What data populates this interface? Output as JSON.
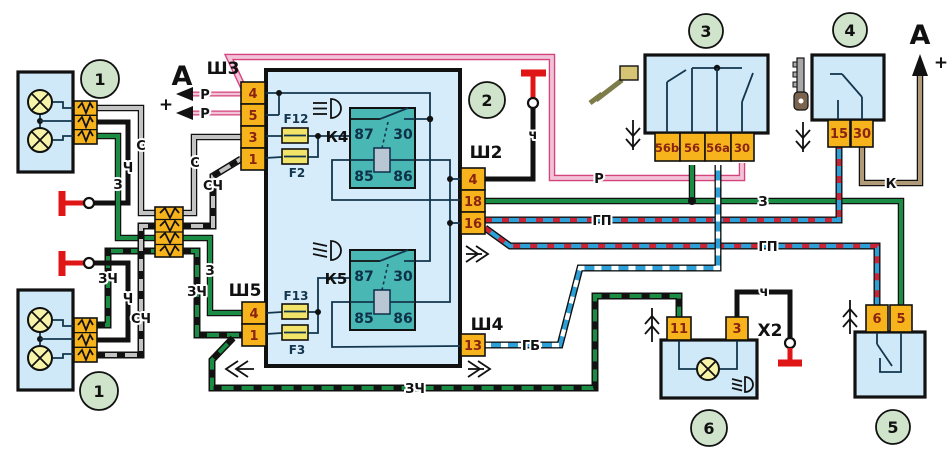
{
  "markers": {
    "a_left": "А",
    "a_right": "А",
    "plus_left": "+",
    "plus_right": "+"
  },
  "callouts": {
    "c1_top": "1",
    "c1_bottom": "1",
    "c2": "2",
    "c3": "3",
    "c4": "4",
    "c5": "5",
    "c6": "6"
  },
  "connectors": {
    "sh3": {
      "label": "Ш3",
      "pins": [
        "4",
        "5",
        "3",
        "1"
      ]
    },
    "sh5": {
      "label": "Ш5",
      "pins": [
        "4",
        "1"
      ]
    },
    "sh2": {
      "label": "Ш2",
      "pins": [
        "4",
        "18",
        "16"
      ]
    },
    "sh4": {
      "label": "Ш4",
      "pins": [
        "13"
      ]
    },
    "x2": "X2"
  },
  "fuses": {
    "f12": "F12",
    "f2": "F2",
    "f13": "F13",
    "f3": "F3"
  },
  "relays": {
    "k4": "К4",
    "k5": "К5",
    "t87": "87",
    "t30": "30",
    "t85": "85",
    "t86": "86"
  },
  "switch3": {
    "pins": [
      "56b",
      "56",
      "56a",
      "30"
    ]
  },
  "switch4": {
    "pins": [
      "15",
      "30"
    ]
  },
  "switch5": {
    "pins": [
      "6",
      "5"
    ]
  },
  "lamp6": {
    "pins": [
      "11",
      "3"
    ]
  },
  "wires": {
    "p1": "Р",
    "p2": "Р",
    "p3": "Р",
    "s_top": "С",
    "s_sh3": "С",
    "sch_sh3": "СЧ",
    "sch_bottom": "СЧ",
    "ch_top": "Ч",
    "ch_bottom": "Ч",
    "z_top": "З",
    "z_sh5": "З",
    "z_main": "З",
    "zch_left": "ЗЧ",
    "zch_sh5": "ЗЧ",
    "zch_bottom": "ЗЧ",
    "gp_upper": "ГП",
    "gp_lower": "ГП",
    "gb": "ГБ",
    "k": "К",
    "ch_ground_sh2": "ч",
    "ch_ground_lamp": "ч"
  }
}
